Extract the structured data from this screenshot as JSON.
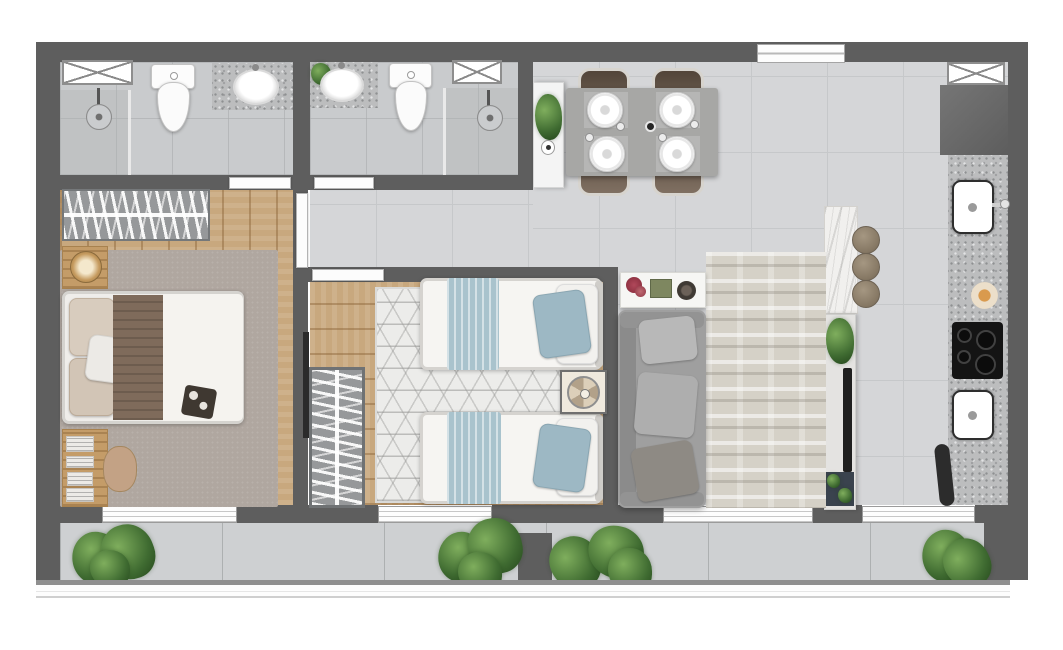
{
  "title": "apartment-floor-plan-top-view",
  "palette": {
    "wall": "#5e5e5e",
    "wall_light": "#6a6a6a",
    "tile": "#d5d6d8",
    "tile_line": "#c6c8ca",
    "bath_tile": "#c9cbcd",
    "balcony_floor": "#ced0d2",
    "wood": "#c8a87e",
    "carpet": "#b0a7a0",
    "hex_rug": "#ececea",
    "living_rug": "#d5d1c7",
    "granite": "#bcbdbe",
    "marble": "#f1f0ee",
    "sofa": "#9f9f9f",
    "blanket_brown": "#7f6b5b",
    "duvet": "#f5f3ef",
    "blue_fabric": "#a9c3cd",
    "chair_brown": "#6e5c4c",
    "dining_table": "#a7a7a5",
    "stool": "#8d7f6f",
    "plant_dark": "#3f6b31",
    "plant_light": "#7fae5d",
    "cooktop": "#141414",
    "tv": "#1f1f1f",
    "rack_navy": "#3a434e",
    "door_white": "#fcfcfc",
    "flower_red": "#b0485a",
    "box_green": "#7e8760"
  },
  "rooms": {
    "bathroom_1": {
      "items": [
        "x-window",
        "shower",
        "shower-head",
        "toilet",
        "granite-vanity",
        "oval-sink"
      ]
    },
    "bathroom_2": {
      "items": [
        "granite-vanity",
        "oval-sink",
        "small-plant",
        "toilet",
        "x-window",
        "shower",
        "shower-head"
      ]
    },
    "bedroom_1": {
      "items": [
        "wardrobe",
        "nightstand",
        "lamp",
        "double-bed",
        "brown-blanket",
        "white-duvet",
        "pillows",
        "breakfast-tray",
        "desk",
        "papers",
        "chair",
        "carpet",
        "balcony-slider"
      ]
    },
    "bedroom_2": {
      "items": [
        "wall-tv",
        "wardrobe",
        "hexagon-rug",
        "twin-bed",
        "twin-bed",
        "blue-blankets",
        "blue-pillows",
        "nightstand",
        "table-fan",
        "balcony-slider"
      ]
    },
    "hallway": {
      "items": [
        "white-console",
        "potted-plant",
        "vase",
        "doors"
      ]
    },
    "dining_area": {
      "items": [
        "dining-table",
        "chair",
        "chair",
        "chair",
        "chair",
        "plates-x4",
        "glasses",
        "entrance-door"
      ]
    },
    "living_room": {
      "items": [
        "decor-console",
        "red-flowers",
        "green-box",
        "dark-bowl",
        "sofa",
        "cushions-x3",
        "distressed-rug",
        "balcony-slider"
      ]
    },
    "kitchen": {
      "items": [
        "x-window",
        "tall-dark-cabinet",
        "granite-counter",
        "sink",
        "faucet",
        "decor-dish",
        "cooktop-4-burners",
        "second-sink",
        "dark-door-leaf",
        "marble-island",
        "stool",
        "stool",
        "stool",
        "tv-rack",
        "tv",
        "rack-plant",
        "navy-shelf-plants",
        "balcony-slider"
      ]
    },
    "balcony": {
      "items": [
        "plant-cluster-left",
        "planter-pot",
        "plant-cluster-mid-left",
        "divider-wall",
        "plant-cluster-mid-right",
        "plant-cluster-right",
        "white-railing"
      ]
    }
  },
  "counts": {
    "bathrooms": 2,
    "bedrooms": 2,
    "dining_chairs": 4,
    "island_stools": 3,
    "twin_beds": 2,
    "balcony_plant_clusters": 4
  }
}
